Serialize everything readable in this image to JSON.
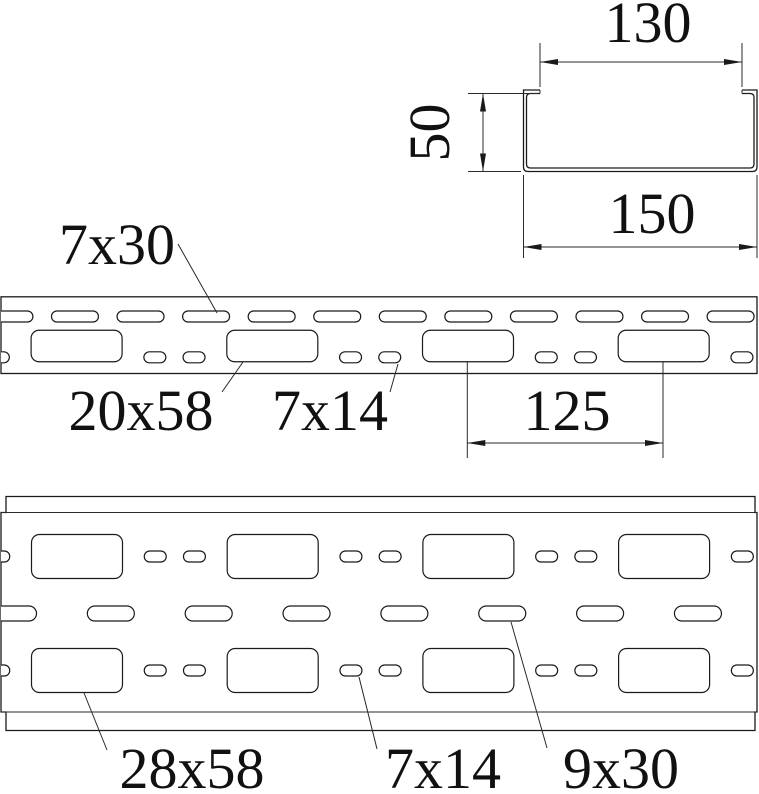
{
  "drawing_title": "cable tray perforation drawing",
  "colors": {
    "line": "#1a1a1a",
    "background": "#ffffff"
  },
  "cross_section": {
    "inner_width": "130",
    "height": "50",
    "outer_width": "150"
  },
  "side_view": {
    "top_slot": "7x30",
    "large_slot": "20x58",
    "small_slot": "7x14",
    "pitch": "125"
  },
  "bottom_view": {
    "large_slot": "28x58",
    "small_slot": "7x14",
    "mid_slot": "9x30"
  }
}
